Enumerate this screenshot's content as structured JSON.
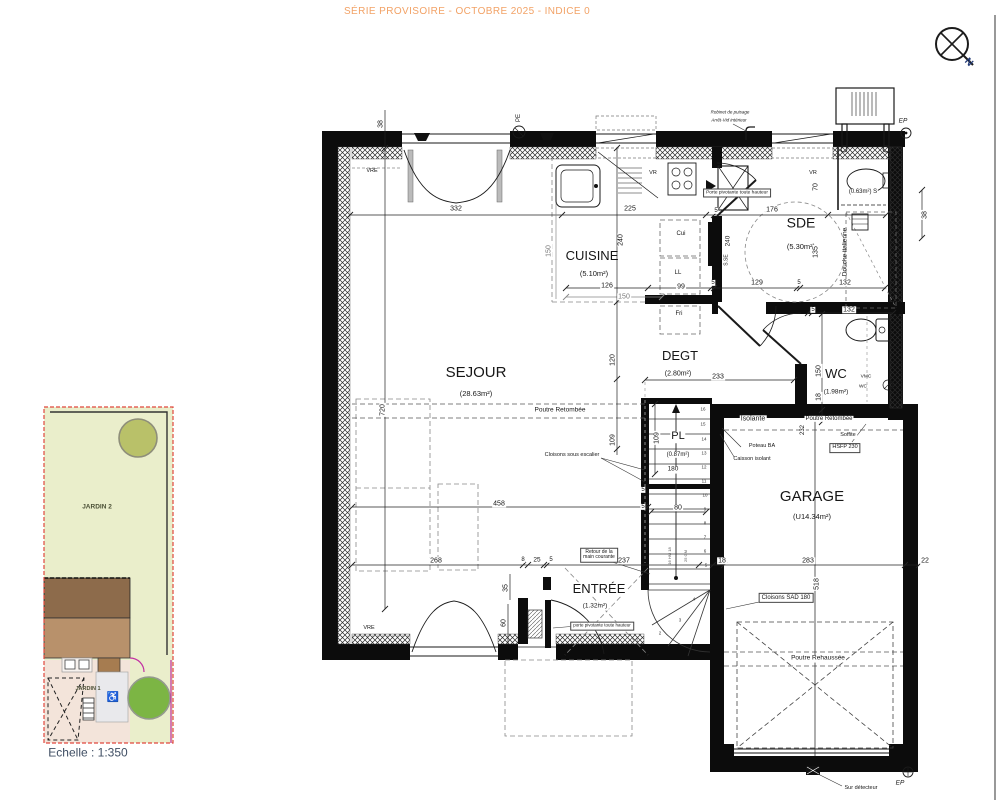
{
  "header": {
    "title": "SÉRIE PROVISOIRE - OCTOBRE 2025 - INDICE 0"
  },
  "compass": {
    "n": "N"
  },
  "site": {
    "jardin2": "JARDIN 2",
    "jardin1": "JARDIN 1",
    "wheelchair": "♿"
  },
  "scale_label": "Echelle : 1:350",
  "rooms": {
    "cuisine": {
      "name": "CUISINE",
      "area": "(5.10m²)"
    },
    "sde": {
      "name": "SDE",
      "area": "(5.30m²)"
    },
    "sejour": {
      "name": "SEJOUR",
      "area": "(28.63m²)"
    },
    "degt": {
      "name": "DEGT",
      "area": "(2.80m²)"
    },
    "wc": {
      "name": "WC",
      "area": "(1.98m²)"
    },
    "pl": {
      "name": "PL",
      "area": "(0.87m²)"
    },
    "garage": {
      "name": "GARAGE",
      "area": "(U14.34m²)"
    },
    "entree": {
      "name": "ENTRÉE",
      "area": "(1.32m²)"
    }
  },
  "dims": {
    "a332": "332",
    "a225": "225",
    "a5_1": "5",
    "a176": "176",
    "b126": "126",
    "b150": "150",
    "b99": "99",
    "c5_1": "5",
    "c129": "129",
    "c5_2": "5",
    "c132": "132",
    "d5": "5",
    "d132": "132",
    "e233": "233",
    "f458": "458",
    "f5": "5",
    "g268": "268",
    "g8": "8",
    "g25": "25",
    "g5": "5",
    "g237": "237",
    "g18": "18",
    "g283": "283",
    "g22": "22",
    "h80": "80",
    "h180": "180",
    "h5": "5",
    "v38l": "38",
    "v720": "720",
    "v150cu": "150",
    "v240cu": "240",
    "v120": "120",
    "v109a": "109",
    "v109b": "109",
    "v240sde": "240",
    "v70": "70",
    "v135": "135",
    "v150wc": "150",
    "v18wc": "18",
    "v35": "35",
    "v60": "60",
    "v518": "518",
    "v38r": "38",
    "v232": "232"
  },
  "annotations": {
    "vre_top": "VRE",
    "vre_bottom": "VRE",
    "vr_cuisine": "VR",
    "vr_sde": "VR",
    "pe": "PE",
    "ep_top": "EP",
    "ep_bottom": "EP",
    "cui": "Cui",
    "ll": "LL",
    "fri": "Fri",
    "sse": "S.SE",
    "s_closet": "(0.63m²) S",
    "porte_pivotante_sde": "Porte pivotante toute hauteur",
    "porte_pivotante_entree": "porte pivotante toute hauteur",
    "douche": "Douche italienne",
    "vmc1": "VMC",
    "vmc2": "WC",
    "isolante": "Isolante",
    "poutre_retombee_sejour": "Poutre Retombée",
    "poutre_retombee_right": "Poutre Retombée",
    "poutre_rehaussee": "Poutre Rehaussée",
    "soffite1": "Soffite",
    "soffite2": "HSFP 230",
    "poteau_ba": "Poteau BA",
    "caisson": "Caisson isolant",
    "cloisons_escalier": "Cloisons sous escalier",
    "retour1": "Retour de la",
    "retour2": "main courante",
    "cloisons_sad": "Cloisons SAD 180",
    "sur_detecteur": "Sur détecteur",
    "robinet1": "Robinet de puisage",
    "robinet2": "Arrêt-Vid intérieur"
  },
  "stairs": {
    "steps": [
      "16",
      "15",
      "14",
      "13",
      "12",
      "11",
      "10",
      "9",
      "8",
      "7",
      "6",
      "5",
      "4",
      "3",
      "2",
      "1"
    ],
    "note1": "16 HM 18",
    "note2": "25 GM"
  }
}
